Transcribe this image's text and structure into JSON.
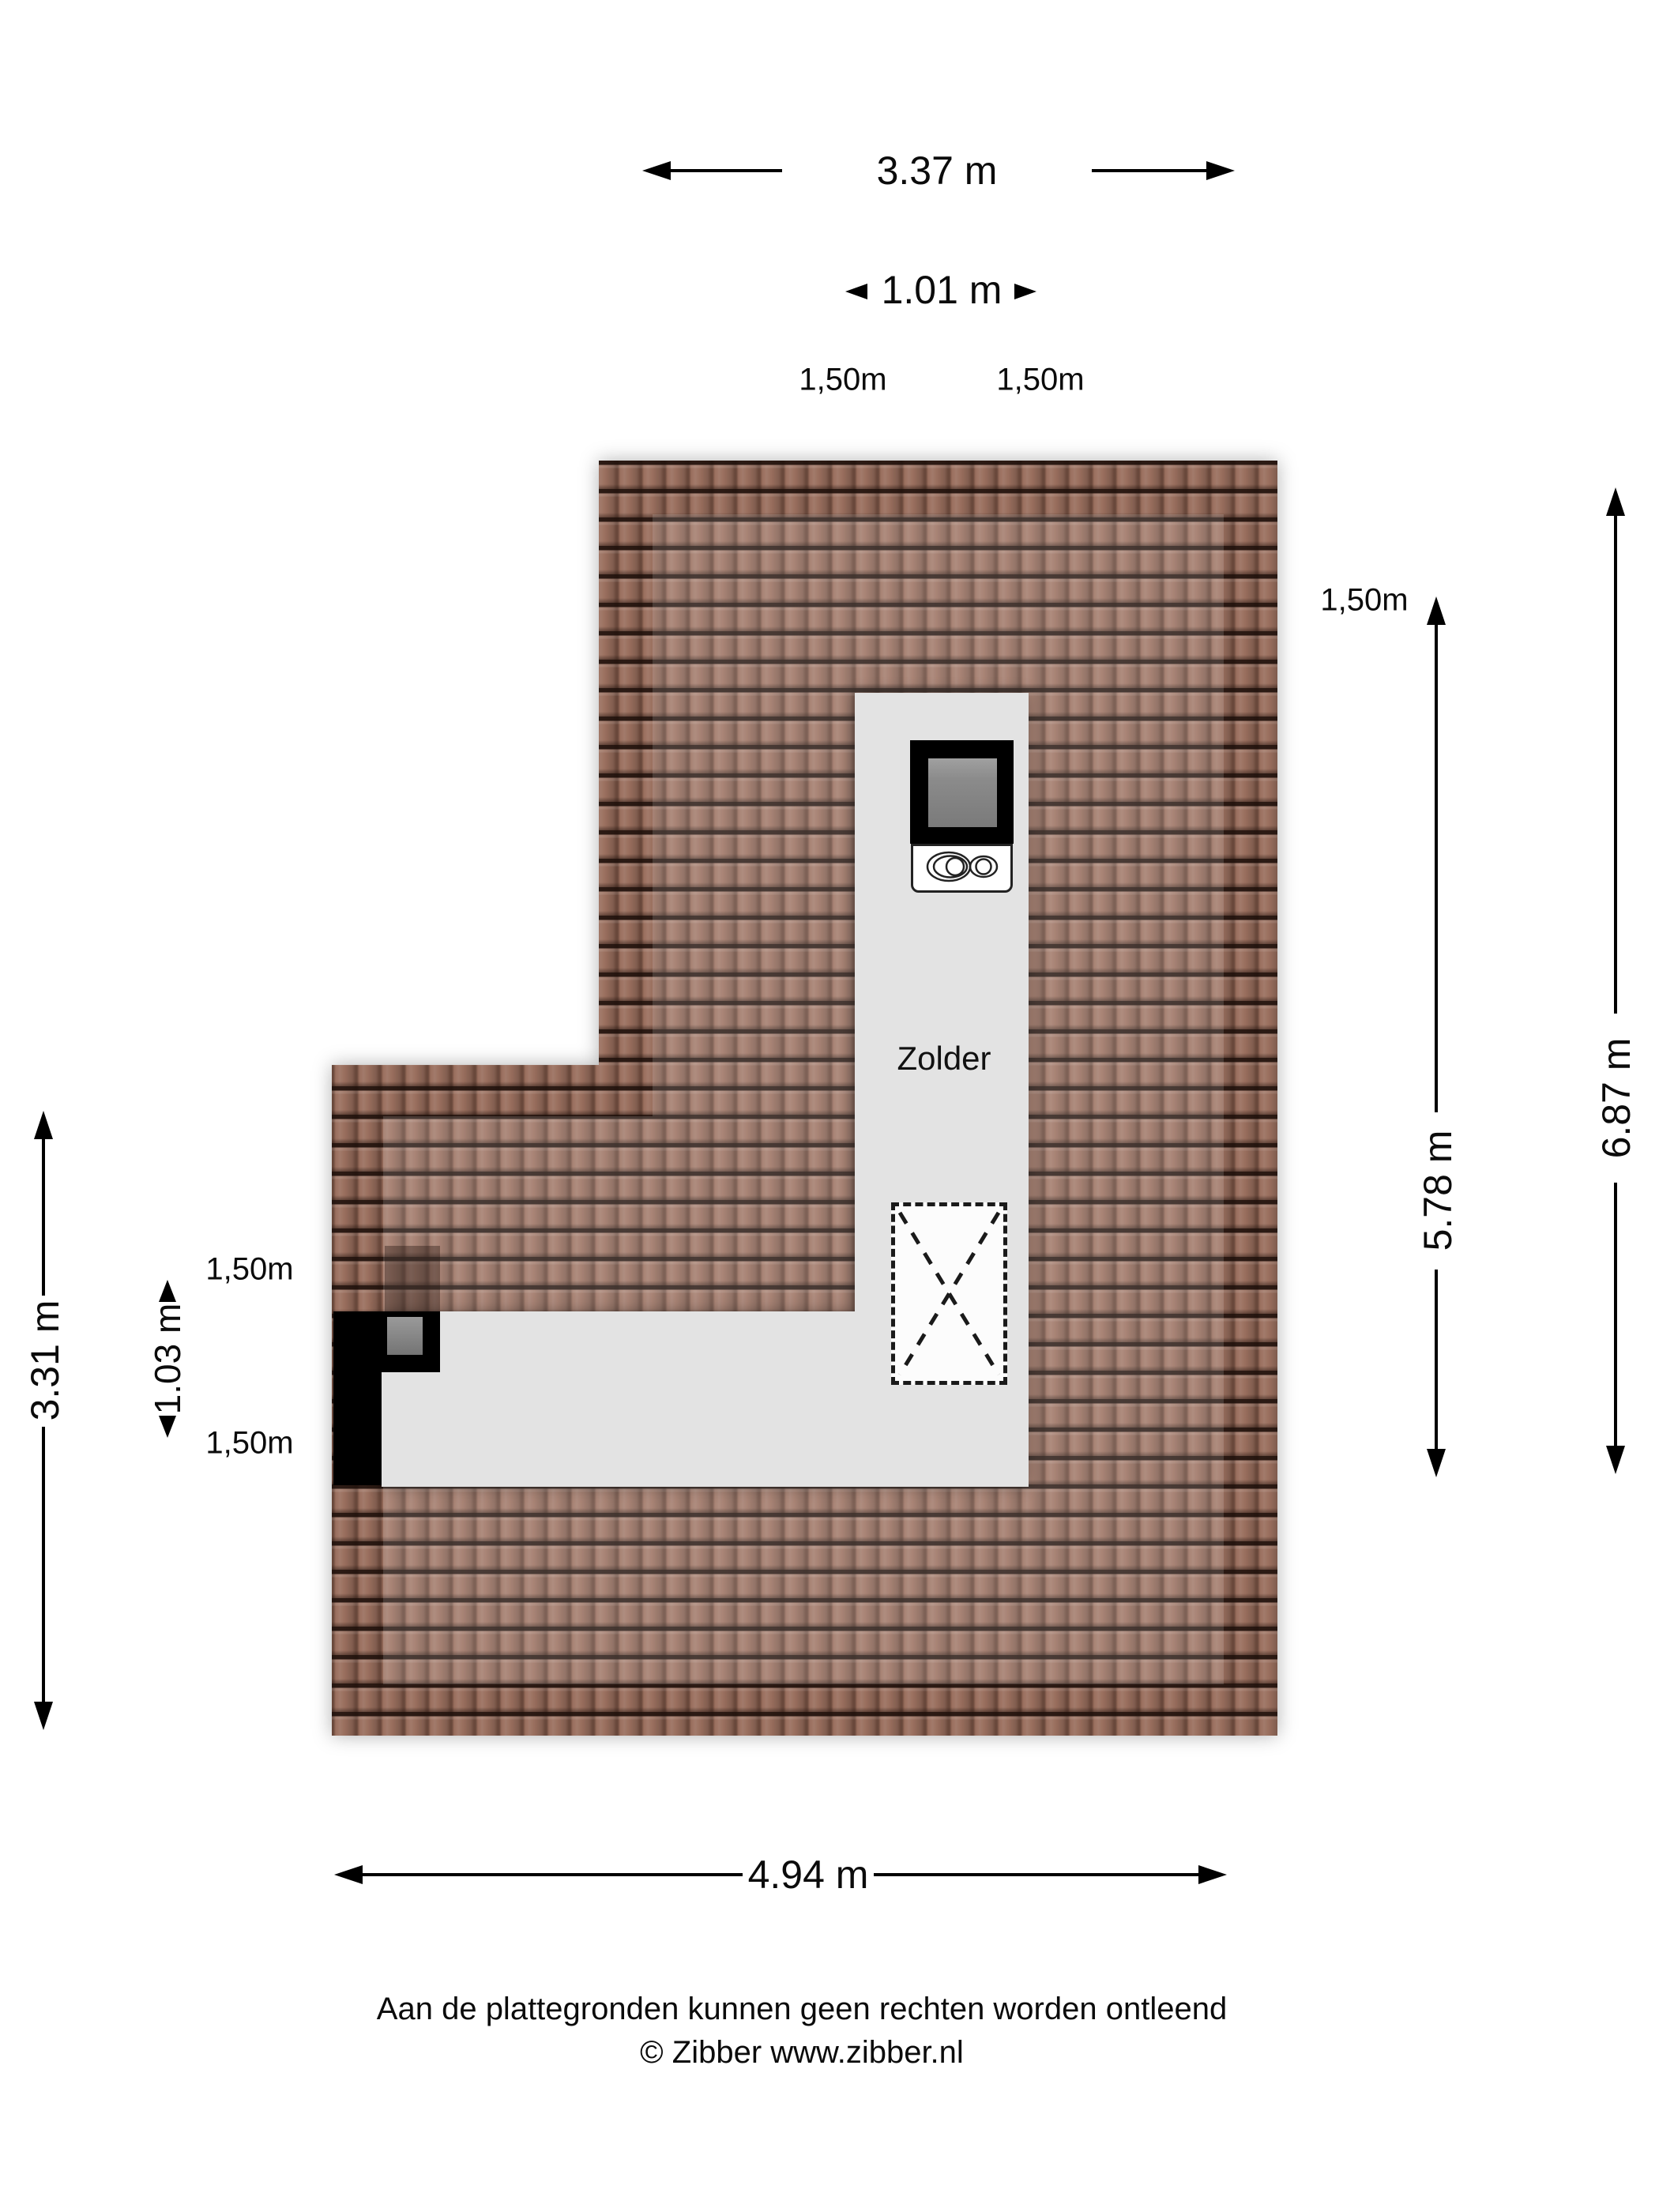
{
  "room_label": "Zolder",
  "dimensions": {
    "top_width": "3.37 m",
    "top_inner_width": "1.01 m",
    "top_left_headroom": "1,50m",
    "top_right_headroom": "1,50m",
    "right_headroom": "1,50m",
    "right_inner_height": "5.78 m",
    "right_outer_height": "6.87 m",
    "left_height": "3.31 m",
    "left_inner_width": "1.03 m",
    "left_headroom_top": "1,50m",
    "left_headroom_bottom": "1,50m",
    "bottom_width": "4.94 m"
  },
  "footer": {
    "disclaimer": "Aan de plattegronden kunnen geen rechten worden ontleend",
    "copyright": "© Zibber www.zibber.nl"
  },
  "colors": {
    "roof_tile": "#9a6f5e",
    "floor_gray": "#e3e3e3",
    "dormer_black": "#000000",
    "background": "#ffffff"
  }
}
